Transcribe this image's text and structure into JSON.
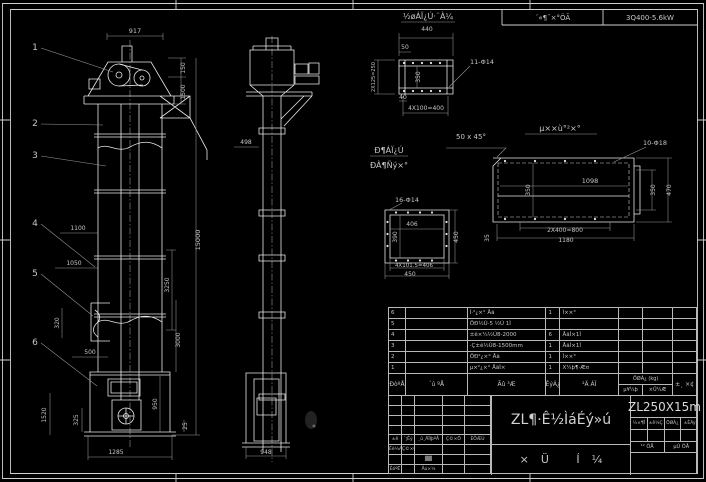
{
  "header": {
    "field1": "´«¶¯×°ÖÃ",
    "field2": "3Q400-5.6kW"
  },
  "drawing": {
    "line_color": "#e8e8e8",
    "dim_color": "#9a9a9a",
    "balloons": [
      {
        "n": "1",
        "tx": 35,
        "ty": 50,
        "x2": 113,
        "y2": 72
      },
      {
        "n": "2",
        "tx": 35,
        "ty": 126,
        "x2": 103,
        "y2": 125
      },
      {
        "n": "3",
        "tx": 35,
        "ty": 158,
        "x2": 106,
        "y2": 166
      },
      {
        "n": "4",
        "tx": 35,
        "ty": 226,
        "x2": 95,
        "y2": 267
      },
      {
        "n": "5",
        "tx": 35,
        "ty": 276,
        "x2": 93,
        "y2": 316
      },
      {
        "n": "6",
        "tx": 35,
        "ty": 345,
        "x2": 97,
        "y2": 386
      }
    ],
    "annotations": [
      {
        "t": "917",
        "x": 135,
        "y": 33,
        "s": 6.5
      },
      {
        "t": "150",
        "x": 185,
        "y": 68,
        "r": -90,
        "s": 6
      },
      {
        "t": "1500",
        "x": 185,
        "y": 92,
        "r": -90,
        "s": 6
      },
      {
        "t": "15000",
        "x": 200,
        "y": 240,
        "r": -90,
        "s": 6.5
      },
      {
        "t": "3250",
        "x": 169,
        "y": 285,
        "r": -90,
        "s": 6
      },
      {
        "t": "3000",
        "x": 180,
        "y": 340,
        "r": -90,
        "s": 6
      },
      {
        "t": "950",
        "x": 157,
        "y": 404,
        "r": -90,
        "s": 6
      },
      {
        "t": "25",
        "x": 187,
        "y": 426,
        "r": -90,
        "s": 6
      },
      {
        "t": "1100",
        "x": 78,
        "y": 230,
        "s": 6
      },
      {
        "t": "1050",
        "x": 74,
        "y": 265,
        "s": 6
      },
      {
        "t": "320",
        "x": 59,
        "y": 323,
        "r": -90,
        "s": 6
      },
      {
        "t": "500",
        "x": 90,
        "y": 354,
        "s": 6
      },
      {
        "t": "1520",
        "x": 46,
        "y": 415,
        "r": -90,
        "s": 6
      },
      {
        "t": "325",
        "x": 78,
        "y": 420,
        "r": -90,
        "s": 6
      },
      {
        "t": "1285",
        "x": 116,
        "y": 454,
        "s": 6
      },
      {
        "t": "498",
        "x": 246,
        "y": 144,
        "s": 6
      },
      {
        "t": "948",
        "x": 266,
        "y": 454,
        "s": 6
      },
      {
        "t": "½øÁÏ¿Ú·¨À¼",
        "x": 428,
        "y": 19,
        "s": 8,
        "u": [
          401,
          22,
          455
        ]
      },
      {
        "t": "440",
        "x": 427,
        "y": 31,
        "s": 6
      },
      {
        "t": "50",
        "x": 405,
        "y": 49,
        "s": 6
      },
      {
        "t": "11-Φ14",
        "x": 482,
        "y": 64,
        "s": 6.5
      },
      {
        "t": "2X125=250",
        "x": 375,
        "y": 77,
        "r": -90,
        "s": 5
      },
      {
        "t": "350",
        "x": 420,
        "y": 77,
        "r": -90,
        "s": 6
      },
      {
        "t": "40",
        "x": 403,
        "y": 99,
        "s": 6
      },
      {
        "t": "4X100=400",
        "x": 426,
        "y": 110,
        "s": 6
      },
      {
        "t": "50 x 45°",
        "x": 471,
        "y": 139,
        "s": 7
      },
      {
        "t": "Ð¶ÁÏ¿Ú",
        "x": 389,
        "y": 153,
        "s": 8,
        "u": [
          370,
          156,
          408
        ]
      },
      {
        "t": "ÐÂ¶Ñý×°",
        "x": 389,
        "y": 168,
        "s": 8
      },
      {
        "t": "µ××ù°²×°",
        "x": 560,
        "y": 131,
        "s": 8,
        "u": [
          525,
          134,
          597
        ]
      },
      {
        "t": "10-Φ18",
        "x": 655,
        "y": 145,
        "s": 6.5
      },
      {
        "t": "1098",
        "x": 590,
        "y": 183,
        "s": 6.5
      },
      {
        "t": "350",
        "x": 530,
        "y": 190,
        "r": -90,
        "s": 6
      },
      {
        "t": "350",
        "x": 655,
        "y": 190,
        "r": -90,
        "s": 6
      },
      {
        "t": "470",
        "x": 671,
        "y": 190,
        "r": -90,
        "s": 6
      },
      {
        "t": "2X400=800",
        "x": 565,
        "y": 232,
        "s": 6
      },
      {
        "t": "1180",
        "x": 566,
        "y": 242,
        "s": 6
      },
      {
        "t": "35",
        "x": 489,
        "y": 238,
        "r": -90,
        "s": 6
      },
      {
        "t": "16-Φ14",
        "x": 407,
        "y": 202,
        "s": 6.5
      },
      {
        "t": "406",
        "x": 412,
        "y": 226,
        "s": 6
      },
      {
        "t": "390",
        "x": 397,
        "y": 237,
        "r": -90,
        "s": 6
      },
      {
        "t": "450",
        "x": 458,
        "y": 237,
        "r": -90,
        "s": 6
      },
      {
        "t": "4X101.5=406",
        "x": 414,
        "y": 267,
        "s": 5.5
      },
      {
        "t": "450",
        "x": 410,
        "y": 276,
        "s": 6
      }
    ]
  },
  "bom": {
    "rows": [
      {
        "no": "6",
        "code": "",
        "name": "Í·²¿×° Åä",
        "qty": "1",
        "mat": "Ì××°",
        "w1": "",
        "w2": "",
        "rem": ""
      },
      {
        "no": "5",
        "code": "",
        "name": "ÖÐ½Ú·5 ½Ú 1Ì",
        "qty": "",
        "mat": "",
        "w1": "",
        "w2": "",
        "rem": ""
      },
      {
        "no": "4",
        "code": "",
        "name": "±ê×¼½Ú8-2000",
        "qty": "6",
        "mat": "ÅäÌ×1Ì",
        "w1": "",
        "w2": "",
        "rem": ""
      },
      {
        "no": "3",
        "code": "",
        "name": "·Ç±ê½Ú8-1500mm",
        "qty": "1",
        "mat": "ÅäÌ×1Ì",
        "w1": "",
        "w2": "",
        "rem": ""
      },
      {
        "no": "2",
        "code": "",
        "name": "ÖÐ²¿×° Åä",
        "qty": "1",
        "mat": "Ì××°",
        "w1": "",
        "w2": "",
        "rem": ""
      },
      {
        "no": "1",
        "code": "",
        "name": "µ×²¿×° ÅäÌ×",
        "qty": "1",
        "mat": "X¼þ¶·Æ¤",
        "w1": "",
        "w2": "",
        "rem": ""
      }
    ],
    "header": {
      "no": "ÐòºÅ",
      "code": "´ú ºÅ",
      "name": "Ãû ³Æ",
      "qty": "ÊýÁ¿",
      "mat": "²Ä ÁÏ",
      "wt_top": "ÖØÁ¿ (kg)",
      "wt_b1": "µ¥¼þ",
      "wt_b2": "×Ü¼Æ",
      "rem": "±¸ ×¢"
    }
  },
  "titleblock": {
    "model": "ZL250X15m",
    "title": "ZL¶·Ê½ÌáÉý»ú",
    "sub": "×Ü Í¼",
    "rev_rows": [
      [
        "",
        "",
        "",
        "",
        ""
      ],
      [
        "",
        "",
        "",
        "",
        ""
      ],
      [
        "",
        "",
        "",
        "",
        ""
      ],
      [
        "",
        "",
        "",
        "",
        ""
      ],
      [
        "±ê",
        "´¦Êý",
        "¸ü¸ÄÎļþºÅ",
        "Ç©×Ö",
        "ÈÕÆÚ"
      ],
      [
        "Éè¼Æ",
        "Ç©×Ö",
        "",
        "",
        ""
      ],
      [
        "",
        "",
        "██",
        "",
        ""
      ],
      [
        "ÉóºË",
        "",
        "Åú×¼",
        "",
        ""
      ]
    ],
    "right_header": [
      "½×¶Î",
      "±ê¼Ç",
      "ÖØÁ¿",
      "±ÈÀý"
    ],
    "sheet": [
      "¹² ÕÅ",
      "µÚ ÕÅ"
    ]
  }
}
